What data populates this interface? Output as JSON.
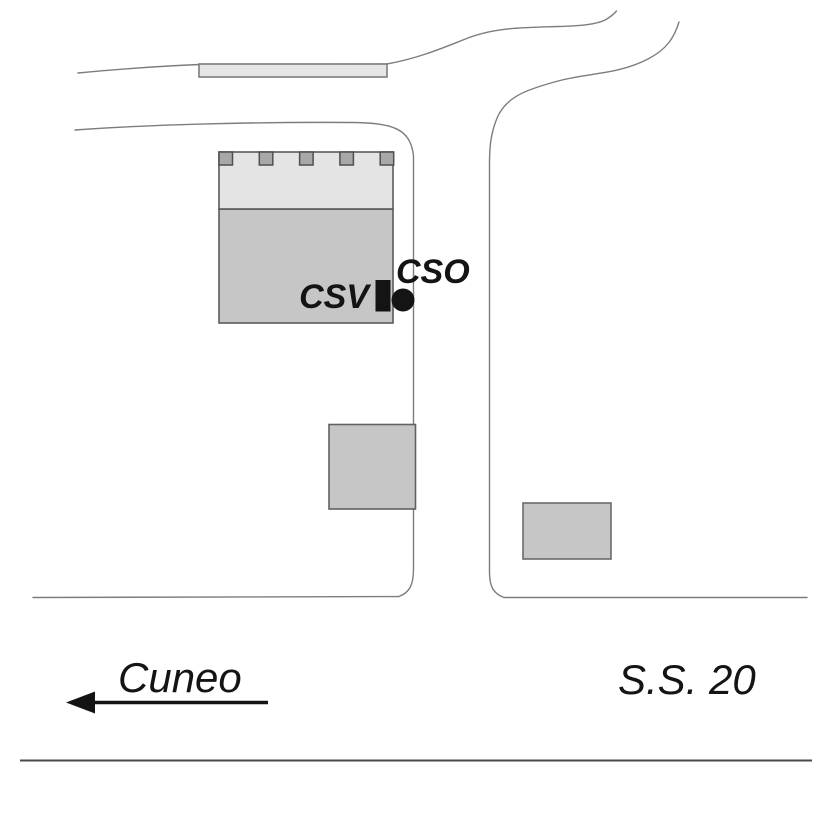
{
  "figure": {
    "type": "location-sketch-map",
    "labels": {
      "csv": "CSV",
      "cso": "CSO",
      "direction": "Cuneo",
      "road_name": "S.S. 20"
    },
    "colors": {
      "background": "#ffffff",
      "road_stroke": "#7d7d7d",
      "building_fill": "#c6c6c6",
      "building_fill_light": "#e4e4e4",
      "bar_fill": "#e6e6e6",
      "battlement_fill": "#a8a8a8",
      "building_stroke": "#5a5a5a",
      "marker_black": "#141414",
      "rule_stroke": "#4a4a4a"
    }
  }
}
